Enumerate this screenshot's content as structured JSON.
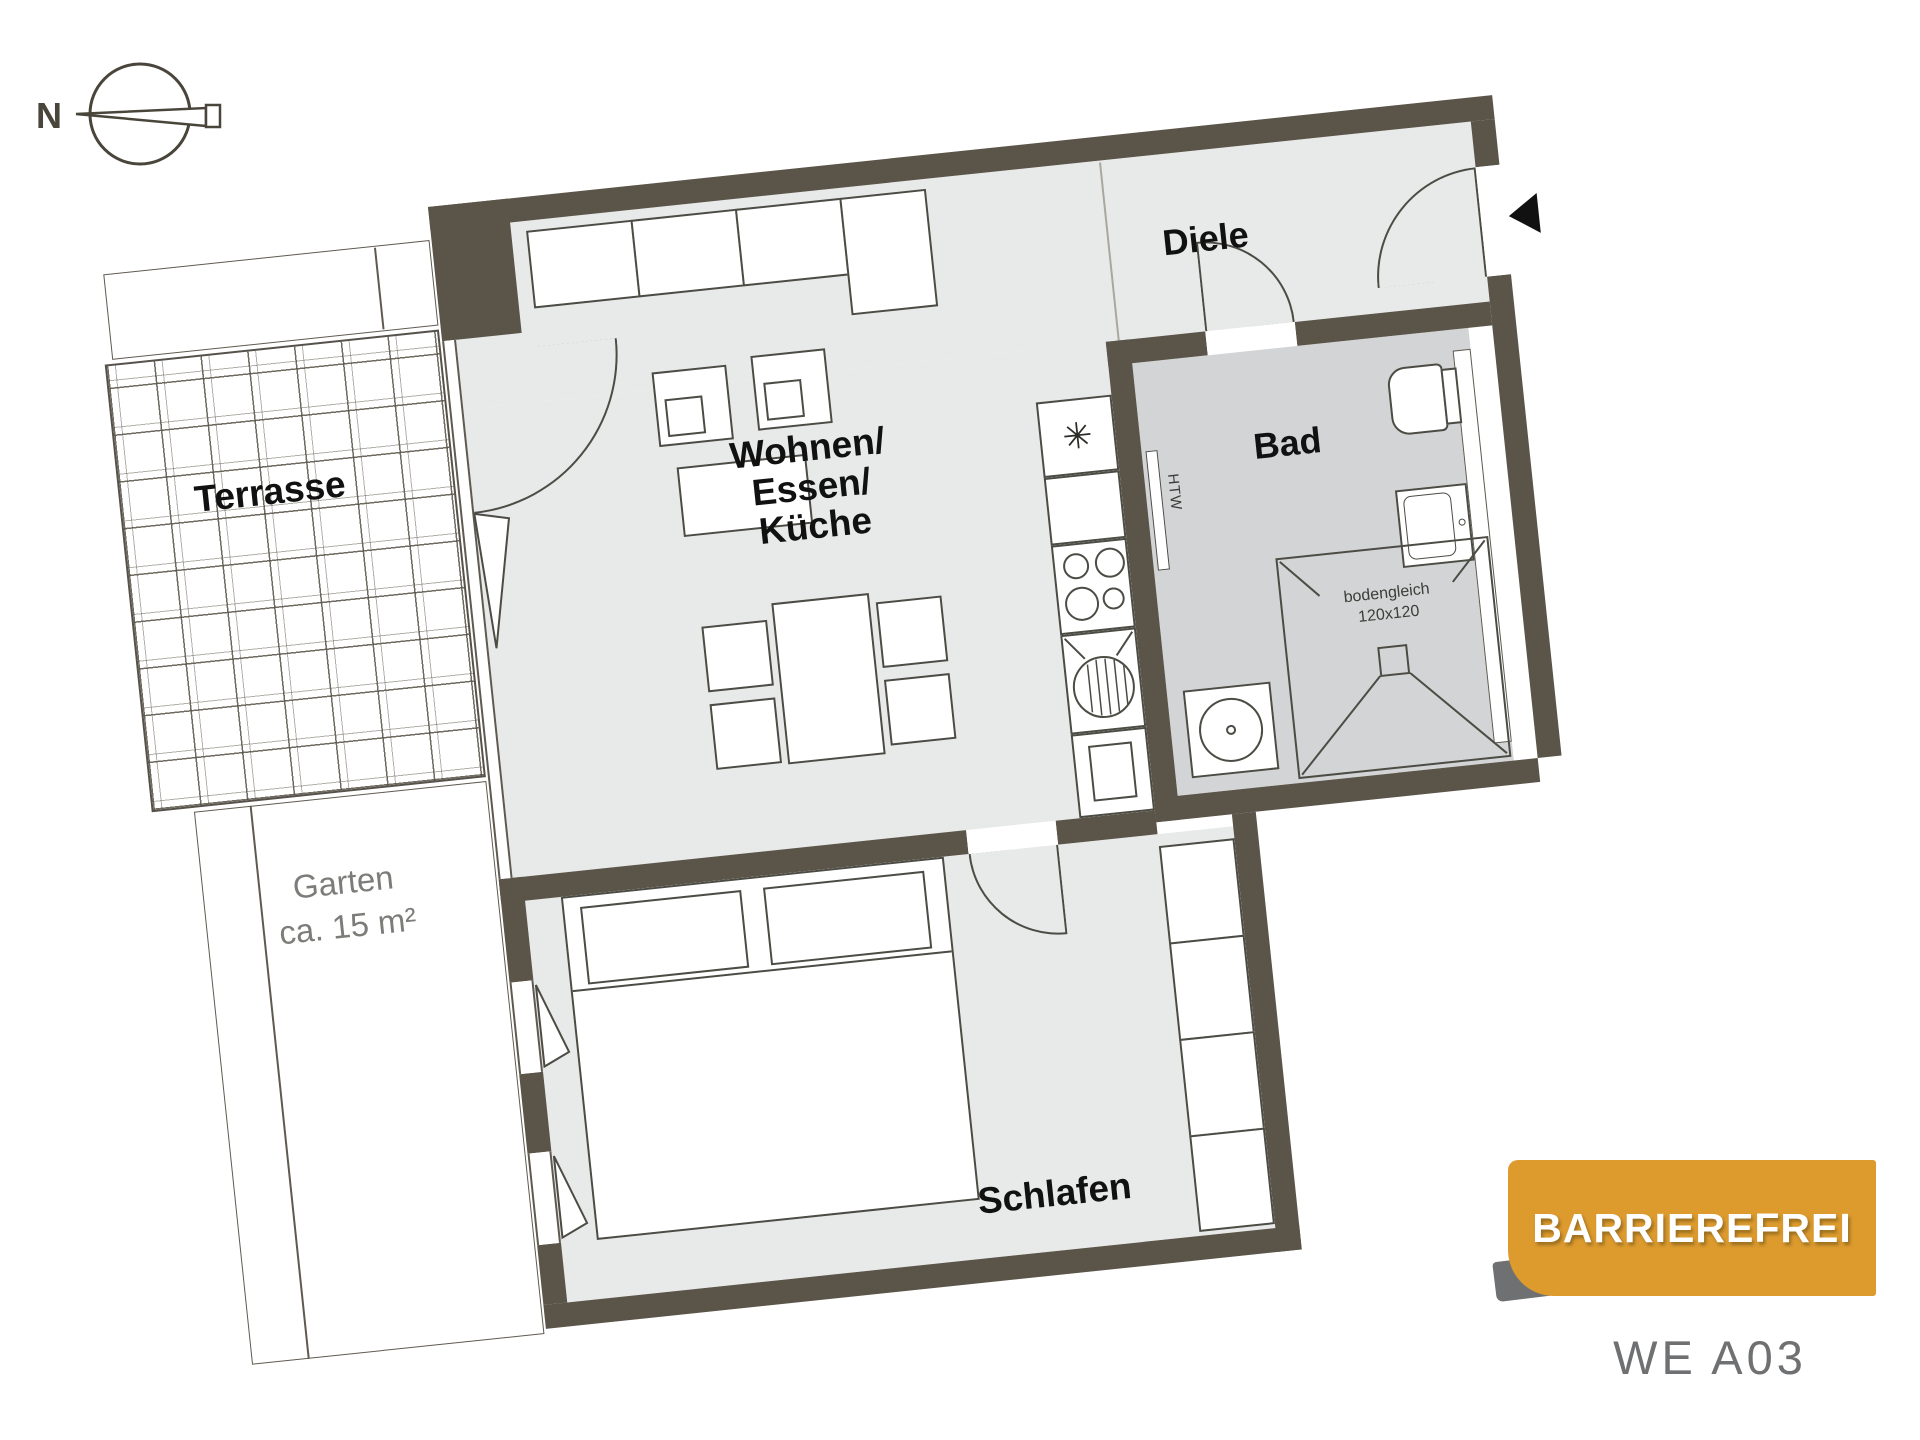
{
  "plan": {
    "compass_label": "N",
    "badge_label": "BARRIEREFREI",
    "unit_label": "WE A03",
    "rooms": {
      "living": {
        "line1": "Wohnen/",
        "line2": "Essen/",
        "line3": "Küche"
      },
      "hall": "Diele",
      "bath": "Bad",
      "bedroom": "Schlafen",
      "terrace": "Terrasse",
      "garden": {
        "line1": "Garten",
        "line2": "ca. 15 m²"
      }
    },
    "annotations": {
      "shower_line1": "bodengleich",
      "shower_line2": "120x120",
      "radiator": "HTW",
      "fridge_symbol": "✳"
    },
    "colors": {
      "wall": "#5a5449",
      "floor": "#e8e9e9",
      "bath_floor": "#d3d4d5",
      "badge": "#dd9b2e",
      "badge_text": "#ffffff",
      "label_gray": "#7c7c79"
    }
  }
}
